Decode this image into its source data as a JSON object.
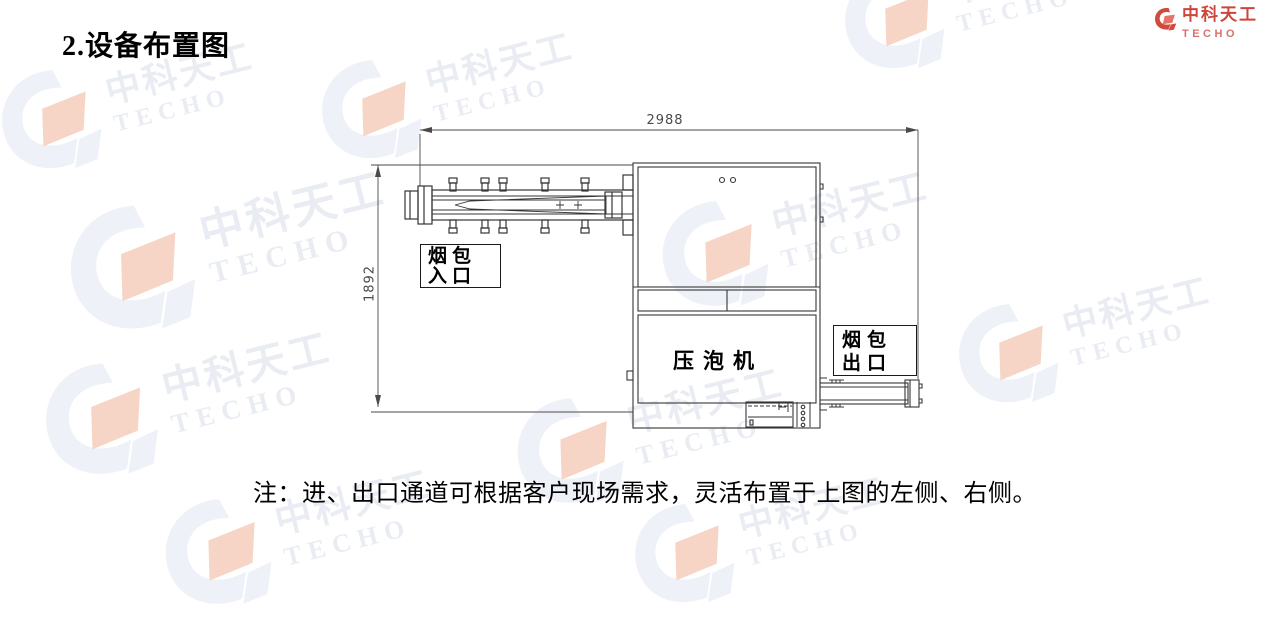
{
  "title": "2.设备布置图",
  "diagram": {
    "dim_width": "2988",
    "dim_height": "1892",
    "inlet_label": {
      "line1": "烟包",
      "line2": "入口"
    },
    "machine_label": "压泡机",
    "outlet_label": {
      "line1": "烟包",
      "line2": "出口"
    }
  },
  "note": "注：进、出口通道可根据客户现场需求，灵活布置于上图的左侧、右侧。",
  "watermark": {
    "text_cn": "中科天工",
    "text_en": "TECHO"
  },
  "corner_logo": {
    "text_cn": "中科天工",
    "text_en": "TECHO"
  },
  "colors": {
    "line": "#3a3a3a",
    "dim_line": "#4a4a4a",
    "accent_red": "#c9372c",
    "accent_red_light": "#d4675e",
    "watermark_gray": "#eef1f7",
    "watermark_peach": "#f6d5c6",
    "watermark_text": "#e9ecf2"
  }
}
